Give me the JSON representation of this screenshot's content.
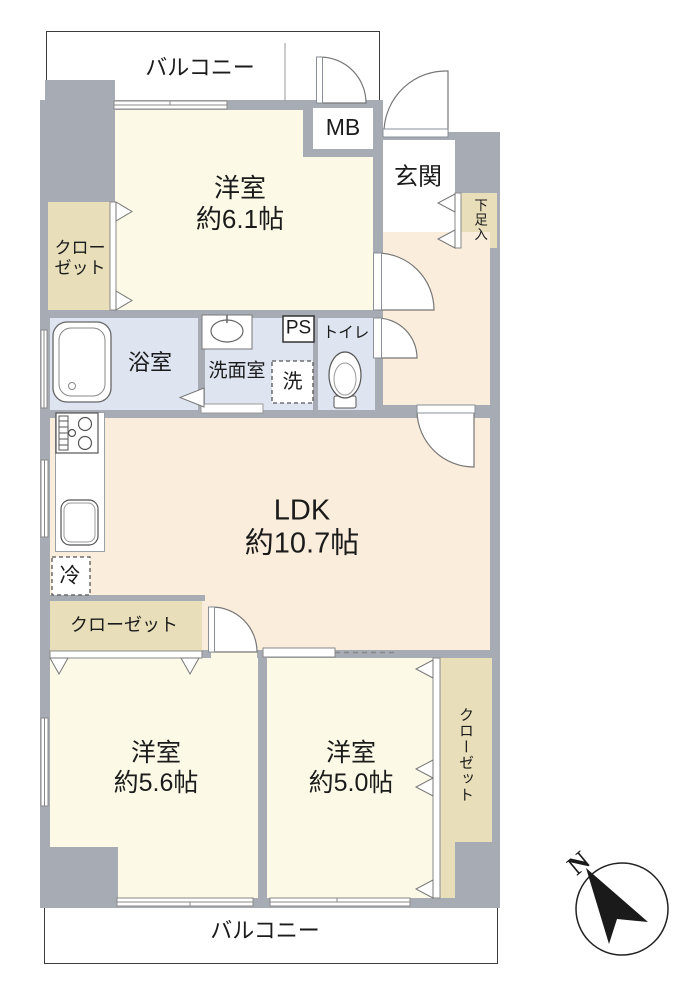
{
  "title": "間取り図",
  "labels": {
    "balcony_top": "バルコニー",
    "balcony_bottom": "バルコニー",
    "bedroom1_name": "洋室",
    "bedroom1_size": "約6.1帖",
    "bedroom2_name": "洋室",
    "bedroom2_size": "約5.6帖",
    "bedroom3_name": "洋室",
    "bedroom3_size": "約5.0帖",
    "ldk_name": "LDK",
    "ldk_size": "約10.7帖",
    "closet_bedroom1_line1": "クロー",
    "closet_bedroom1_line2": "ゼット",
    "closet_ldk": "クローゼット",
    "closet_bedroom3": "クローゼット",
    "genkan": "玄関",
    "shoe_cabinet": "下足入",
    "bath": "浴室",
    "washroom": "洗面室",
    "washer": "洗",
    "ps": "PS",
    "toilet": "トイレ",
    "mb": "MB",
    "fridge": "冷",
    "north": "N"
  },
  "colors": {
    "wall": "#a7acb4",
    "room_cream": "#fcfae7",
    "ldk_peach": "#faeddb",
    "water_blue": "#dee5f1",
    "closet_beige": "#e8dfba",
    "outline": "#3c3c3c"
  }
}
